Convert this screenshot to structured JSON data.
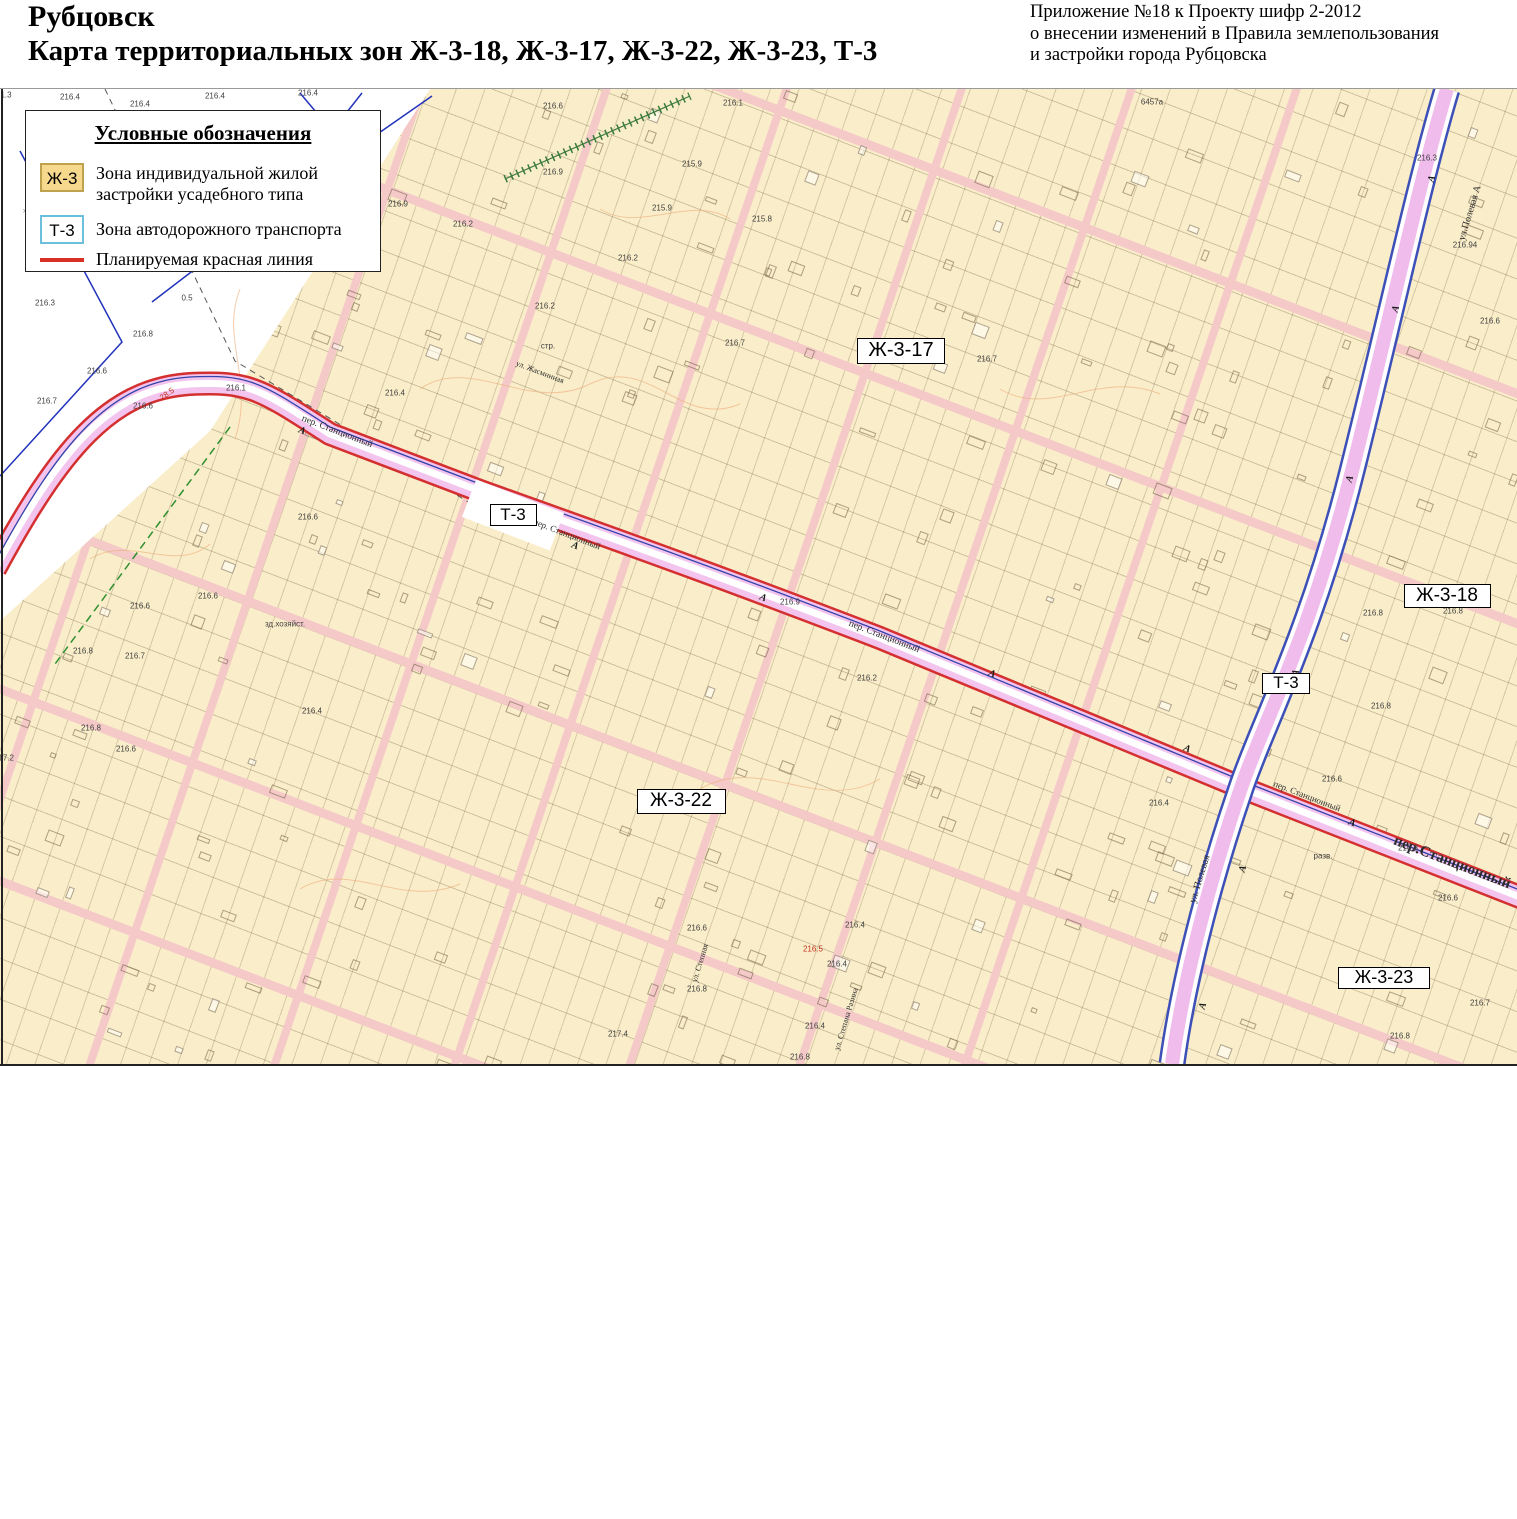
{
  "header": {
    "title": "Рубцовск",
    "subtitle": "Карта территориальных зон Ж-3-18, Ж-3-17, Ж-3-22, Ж-3-23, Т-3",
    "annotation_lines": [
      "Приложение №18 к Проекту шифр 2-2012",
      "о внесении изменений в Правила землепользования",
      "и застройки города Рубцовска"
    ]
  },
  "legend": {
    "title": "Условные обозначения",
    "items": [
      {
        "code": "Ж-3",
        "label1": "Зона индивидуальной жилой",
        "label2": "застройки усадебного типа"
      },
      {
        "code": "Т-3",
        "label1": "Зона автодорожного транспорта",
        "label2": ""
      },
      {
        "code": "",
        "label1": "Планируемая красная линия",
        "label2": ""
      }
    ]
  },
  "map": {
    "colors": {
      "zone_fill": "#faeeca",
      "road_fill": "#f2c4ee",
      "road_red": "#d43030",
      "street_fill": "#f4c9c8",
      "transport_blue": "#3c50b8",
      "red_line": "#d93025",
      "legend_zh3_fill": "#f7d98e",
      "legend_zh3_border": "#bfa24e",
      "legend_t3_border": "#6cc0dc"
    },
    "zone_labels": [
      {
        "text": "Ж-3-17",
        "x": 901,
        "y": 350,
        "w": 88,
        "h": 26,
        "fs": 20
      },
      {
        "text": "Т-3",
        "x": 513,
        "y": 514,
        "w": 47,
        "h": 22,
        "fs": 17
      },
      {
        "text": "Ж-3-18",
        "x": 1447,
        "y": 595,
        "w": 87,
        "h": 24,
        "fs": 19
      },
      {
        "text": "Т-3",
        "x": 1286,
        "y": 682,
        "w": 48,
        "h": 21,
        "fs": 17
      },
      {
        "text": "Ж-3-22",
        "x": 681,
        "y": 800,
        "w": 89,
        "h": 25,
        "fs": 19
      },
      {
        "text": "Ж-3-23",
        "x": 1384,
        "y": 977,
        "w": 92,
        "h": 22,
        "fs": 18
      }
    ],
    "street_labels": [
      {
        "text": "пер. Станционный",
        "x": 337,
        "y": 431,
        "r": 21,
        "fs": 9.5,
        "b": false
      },
      {
        "text": "пер. Станционный",
        "x": 567,
        "y": 533,
        "r": 21,
        "fs": 9,
        "b": false
      },
      {
        "text": "пер. Станционный",
        "x": 884,
        "y": 636,
        "r": 21,
        "fs": 9.5,
        "b": false
      },
      {
        "text": "пер. Станционный",
        "x": 1307,
        "y": 795,
        "r": 21,
        "fs": 9,
        "b": false
      },
      {
        "text": "пер.Станционный",
        "x": 1452,
        "y": 862,
        "r": 21,
        "fs": 15,
        "b": true
      },
      {
        "text": "ул.Полевая  А",
        "x": 1470,
        "y": 212,
        "r": -73,
        "fs": 10,
        "b": false
      },
      {
        "text": "ул. Полевая",
        "x": 1200,
        "y": 878,
        "r": -73,
        "fs": 10,
        "b": false
      },
      {
        "text": "ул. Жасминная",
        "x": 540,
        "y": 371,
        "r": 21,
        "fs": 8,
        "b": false
      },
      {
        "text": "ул. Степная",
        "x": 700,
        "y": 962,
        "r": -73,
        "fs": 8,
        "b": false
      },
      {
        "text": "ул. Степана Разина",
        "x": 846,
        "y": 1018,
        "r": -73,
        "fs": 8,
        "b": false
      }
    ],
    "elevation_marks": [
      {
        "t": "1.3",
        "x": 6,
        "y": 94
      },
      {
        "t": "216.4",
        "x": 70,
        "y": 96
      },
      {
        "t": "216.4",
        "x": 140,
        "y": 103
      },
      {
        "t": "216.4",
        "x": 215,
        "y": 95
      },
      {
        "t": "216.4",
        "x": 308,
        "y": 92
      },
      {
        "t": "0.5",
        "x": 187,
        "y": 297
      },
      {
        "t": "216.3",
        "x": 45,
        "y": 302
      },
      {
        "t": "216.8",
        "x": 143,
        "y": 333
      },
      {
        "t": "216.6",
        "x": 97,
        "y": 370
      },
      {
        "t": "216.7",
        "x": 47,
        "y": 400
      },
      {
        "t": "216.6",
        "x": 143,
        "y": 405
      },
      {
        "t": "216.1",
        "x": 236,
        "y": 387
      },
      {
        "t": "28.5",
        "x": 167,
        "y": 393,
        "c": "red",
        "r": -35
      },
      {
        "t": "216.9",
        "x": 398,
        "y": 203
      },
      {
        "t": "216.6",
        "x": 553,
        "y": 105
      },
      {
        "t": "216.9",
        "x": 553,
        "y": 171
      },
      {
        "t": "216.2",
        "x": 463,
        "y": 223
      },
      {
        "t": "215.9",
        "x": 692,
        "y": 163
      },
      {
        "t": "215.9",
        "x": 662,
        "y": 207
      },
      {
        "t": "215.8",
        "x": 762,
        "y": 218
      },
      {
        "t": "216.2",
        "x": 628,
        "y": 257
      },
      {
        "t": "216.2",
        "x": 545,
        "y": 305
      },
      {
        "t": "216.7",
        "x": 735,
        "y": 342
      },
      {
        "t": "стр.",
        "x": 548,
        "y": 345
      },
      {
        "t": "216.1",
        "x": 733,
        "y": 102
      },
      {
        "t": "216.4",
        "x": 395,
        "y": 392
      },
      {
        "t": "216.7",
        "x": 987,
        "y": 358
      },
      {
        "t": "216.6",
        "x": 208,
        "y": 595
      },
      {
        "t": "216.6",
        "x": 140,
        "y": 605
      },
      {
        "t": "216.8",
        "x": 83,
        "y": 650
      },
      {
        "t": "216.7",
        "x": 135,
        "y": 655
      },
      {
        "t": "216.8",
        "x": 91,
        "y": 727
      },
      {
        "t": "216.6",
        "x": 126,
        "y": 748
      },
      {
        "t": "216.4",
        "x": 312,
        "y": 710
      },
      {
        "t": "217.2",
        "x": 4,
        "y": 757
      },
      {
        "t": "зд.хозяйст.",
        "x": 285,
        "y": 623
      },
      {
        "t": "216.6",
        "x": 308,
        "y": 516
      },
      {
        "t": "216.9",
        "x": 790,
        "y": 601
      },
      {
        "t": "216.2",
        "x": 867,
        "y": 677
      },
      {
        "t": "216.4",
        "x": 1159,
        "y": 802
      },
      {
        "t": "216.6",
        "x": 1332,
        "y": 778
      },
      {
        "t": "216.8",
        "x": 1408,
        "y": 847
      },
      {
        "t": "216.6",
        "x": 1448,
        "y": 897
      },
      {
        "t": "разв.",
        "x": 1323,
        "y": 855
      },
      {
        "t": "216.8",
        "x": 1373,
        "y": 612
      },
      {
        "t": "216.8",
        "x": 1453,
        "y": 610
      },
      {
        "t": "216.8",
        "x": 1381,
        "y": 705
      },
      {
        "t": "216.3",
        "x": 1427,
        "y": 157
      },
      {
        "t": "216.94",
        "x": 1465,
        "y": 244
      },
      {
        "t": "216.6",
        "x": 1490,
        "y": 320
      },
      {
        "t": "216.8",
        "x": 1400,
        "y": 1035
      },
      {
        "t": "216.7",
        "x": 1480,
        "y": 1002
      },
      {
        "t": "216.6",
        "x": 697,
        "y": 927
      },
      {
        "t": "216.4",
        "x": 855,
        "y": 924
      },
      {
        "t": "216.5",
        "x": 813,
        "y": 948,
        "c": "red"
      },
      {
        "t": "216.4",
        "x": 837,
        "y": 963
      },
      {
        "t": "216.8",
        "x": 697,
        "y": 988
      },
      {
        "t": "216.4",
        "x": 815,
        "y": 1025
      },
      {
        "t": "217.4",
        "x": 618,
        "y": 1033
      },
      {
        "t": "216.8",
        "x": 800,
        "y": 1056
      },
      {
        "t": "6457a",
        "x": 1152,
        "y": 101
      },
      {
        "t": "×",
        "x": 25,
        "y": 210,
        "c": "gray"
      },
      {
        "t": "×",
        "x": 150,
        "y": 195,
        "c": "gray"
      },
      {
        "t": "×",
        "x": 243,
        "y": 262,
        "c": "gray"
      }
    ],
    "road_marks": [
      {
        "t": "А",
        "x": 302,
        "y": 430,
        "r": 21
      },
      {
        "t": "А",
        "x": 575,
        "y": 545,
        "r": 21
      },
      {
        "t": "А",
        "x": 763,
        "y": 597,
        "r": 21
      },
      {
        "t": "А",
        "x": 992,
        "y": 673,
        "r": 21
      },
      {
        "t": "А",
        "x": 1187,
        "y": 748,
        "r": 21
      },
      {
        "t": "А",
        "x": 1352,
        "y": 822,
        "r": 21
      },
      {
        "t": "А",
        "x": 1432,
        "y": 178,
        "r": -73
      },
      {
        "t": "А",
        "x": 1396,
        "y": 308,
        "r": -73
      },
      {
        "t": "А",
        "x": 1350,
        "y": 478,
        "r": -73
      },
      {
        "t": "А",
        "x": 1296,
        "y": 672,
        "r": -73
      },
      {
        "t": "А",
        "x": 1243,
        "y": 868,
        "r": -73
      },
      {
        "t": "А",
        "x": 1203,
        "y": 1005,
        "r": -73
      }
    ]
  }
}
